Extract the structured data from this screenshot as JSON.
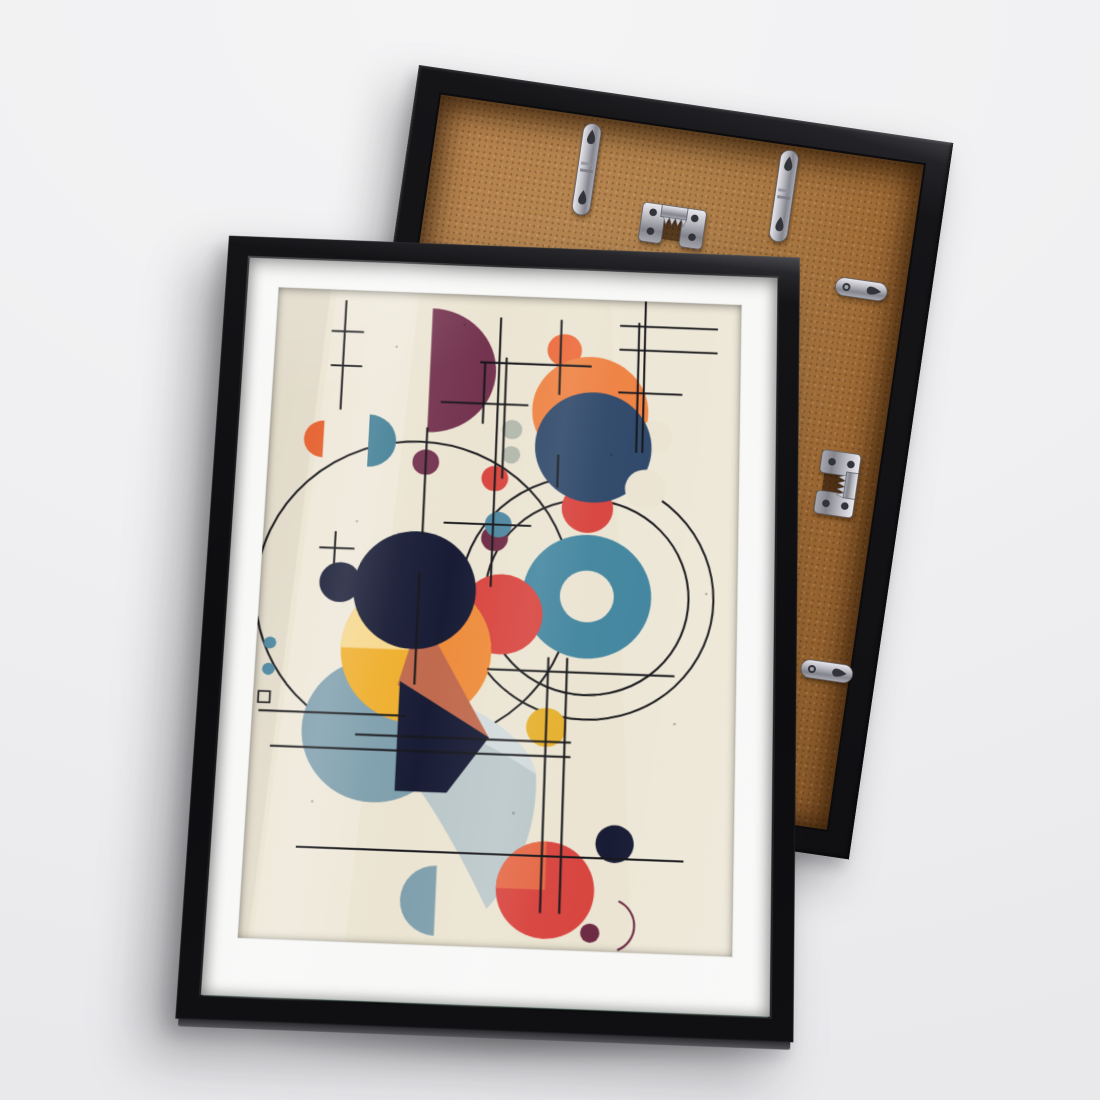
{
  "scene": {
    "wall_color": "#f0f0f2",
    "items": [
      "framed abstract art print, front view",
      "picture frame rear view with hanging hardware"
    ]
  },
  "front_frame": {
    "frame_color": "#121215",
    "mat_color": "#f8f8f7"
  },
  "back_frame": {
    "frame_color": "#17171a",
    "backing_color": "#a87338",
    "hardware": {
      "top_left_strap": "keyhole hanger strap",
      "top_right_strap": "keyhole hanger strap",
      "top_center_sawtooth": "sawtooth hanger",
      "right_upper_strap": "keyhole hanger strap",
      "right_middle_sawtooth": "sawtooth hanger",
      "right_lower_strap": "keyhole hanger strap"
    }
  },
  "art": {
    "style": "mid-century abstract geometric poster",
    "palette": {
      "cream": "#ebe4d2",
      "ink": "#17171b",
      "plum": "#74344f",
      "maroon": "#6d2b44",
      "orange": "#ee8243",
      "orange_small": "#ec6a3a",
      "orange_half": "#e5602e",
      "amber": "#ee8c3c",
      "terracotta": "#c06a4e",
      "yellow": "#efaf2e",
      "yellow_pale": "#f6d88e",
      "gold": "#e6b02e",
      "navy": "#30496a",
      "dark": "#181c35",
      "teal": "#3d7b92",
      "teal_small": "#4e87a0",
      "donut": "#4587a0",
      "red": "#d8453f",
      "red_soft": "#e56a48",
      "slate": "#7f9fad",
      "slate_light": "#bac7c9",
      "sage": "#b3b8ac",
      "metal_dark": "#33333a"
    }
  }
}
